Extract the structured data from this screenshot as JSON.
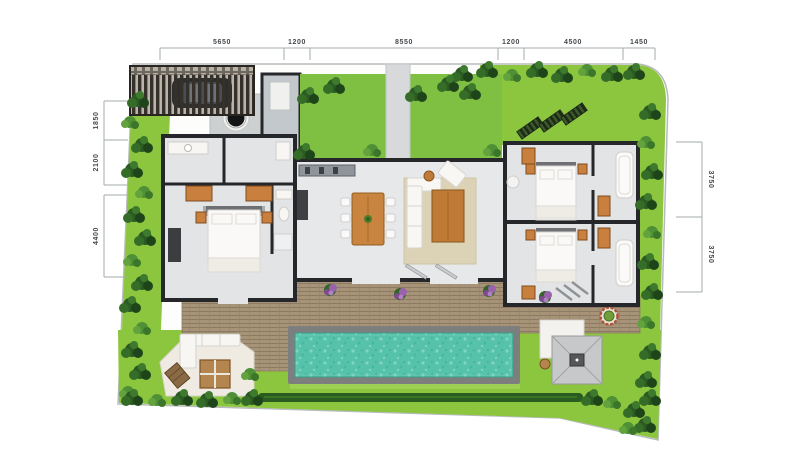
{
  "title": "villa-site-plan",
  "dimensions": {
    "top": [
      "5650",
      "1200",
      "8550",
      "1200",
      "4500",
      "1450"
    ],
    "left": [
      "1850",
      "2100",
      "4400"
    ],
    "right": [
      "3750",
      "3750"
    ]
  },
  "colors": {
    "lawn": "#8cc63e",
    "courtyard_lawn": "#7fc043",
    "hedge_dark": "#2c5a23",
    "pool_water": "#56c2a9",
    "pool_coping": "#7c7f7e",
    "deck_wood": "#a79378",
    "wall": "#26272b",
    "floor": "#e4e6e8",
    "furniture_wood": "#c9813f",
    "terrace_stone": "#efebe3",
    "flower_purple": "#9a62ab",
    "dimension_line": "#a6abad"
  }
}
